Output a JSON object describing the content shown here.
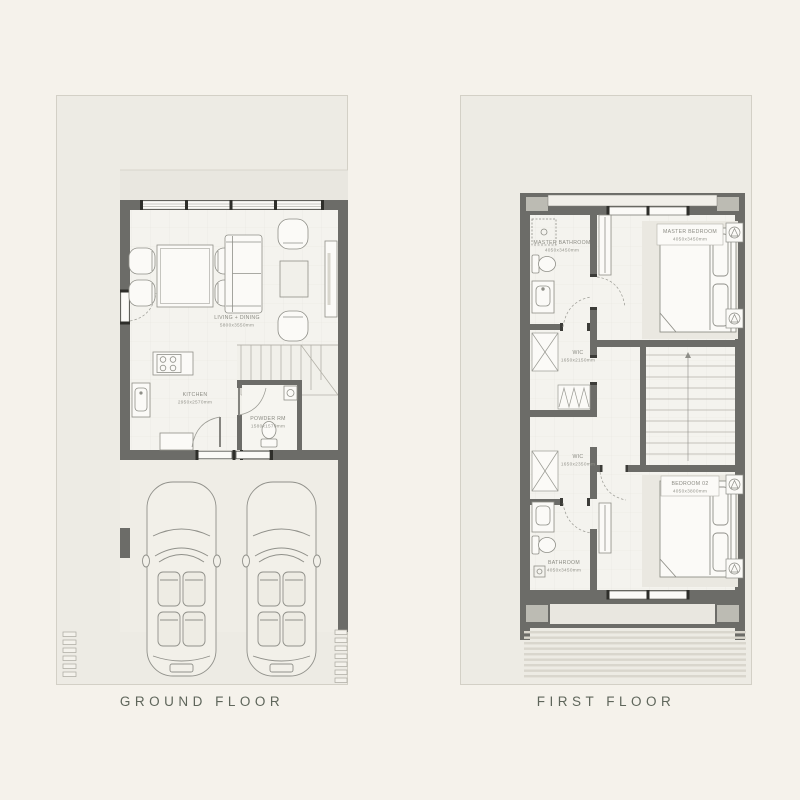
{
  "page": {
    "background_color": "#f5f2eb"
  },
  "titles": {
    "ground": "GROUND FLOOR",
    "first": "FIRST FLOOR"
  },
  "ground_floor": {
    "rooms": [
      {
        "name": "LIVING + DINING",
        "dims": "5800x3550mm"
      },
      {
        "name": "KITCHEN",
        "dims": "2950x2570mm"
      },
      {
        "name": "POWDER RM",
        "dims": "1580x1570mm"
      }
    ]
  },
  "first_floor": {
    "rooms": [
      {
        "name": "MASTER BATHROOM",
        "dims": "4050x3450mm"
      },
      {
        "name": "MASTER BEDROOM",
        "dims": "4050x3450mm"
      },
      {
        "name": "WIC",
        "dims": "1650x2150mm"
      },
      {
        "name": "WIC",
        "dims": "1650x2350mm"
      },
      {
        "name": "BATHROOM",
        "dims": "4050x3450mm"
      },
      {
        "name": "BEDROOM 02",
        "dims": "4050x3800mm"
      }
    ]
  },
  "colors": {
    "wall": "#6c6c68",
    "plot": "#edebe4",
    "title_text": "#5f665b",
    "label_text": "#8b8b83"
  }
}
